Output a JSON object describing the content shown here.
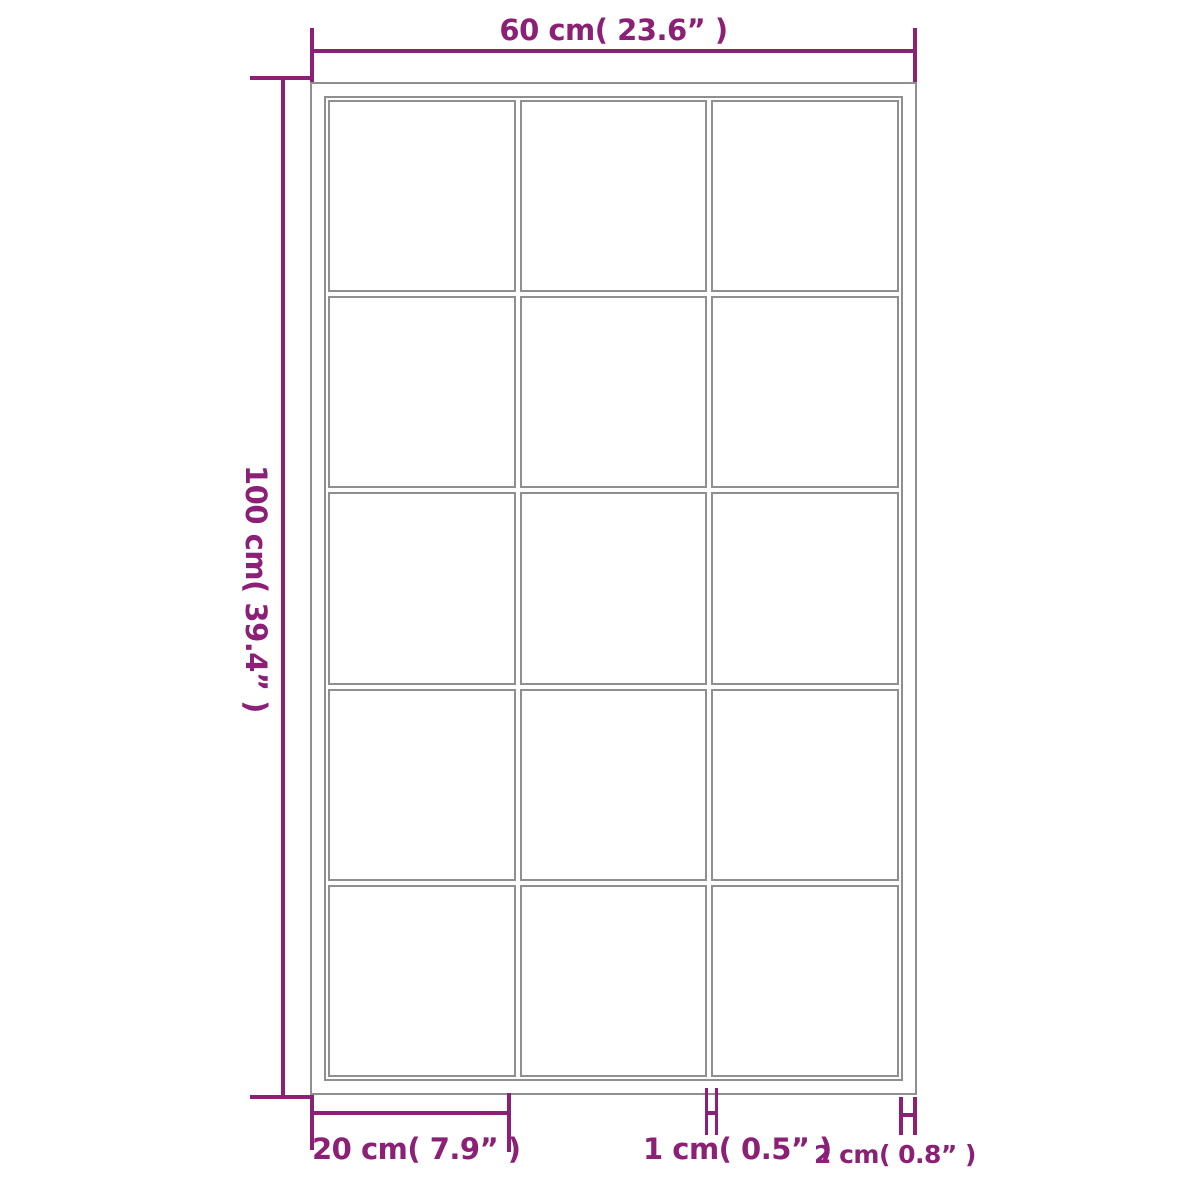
{
  "diagram": {
    "accent_color": "#8B2076",
    "frame_color": "#8f8f8f",
    "grid": {
      "columns": 3,
      "rows": 5
    },
    "dimensions": {
      "width": {
        "label": "60 cm( 23.6”  )"
      },
      "height": {
        "label": "100 cm( 39.4”  )"
      },
      "pane": {
        "label": "20 cm( 7.9”  )"
      },
      "muntin": {
        "label": "1 cm( 0.5”  )"
      },
      "frame": {
        "label": "2 cm( 0.8”  )"
      }
    }
  }
}
